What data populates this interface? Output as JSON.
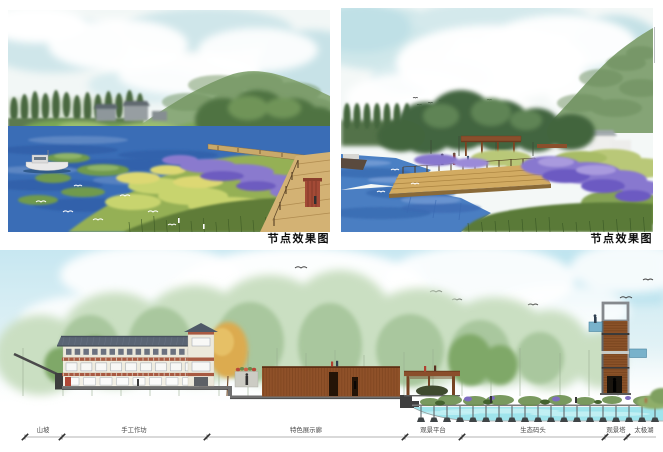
{
  "renderings": [
    {
      "caption": "节点效果图"
    },
    {
      "caption": "节点效果图"
    }
  ],
  "section": {
    "labels": [
      {
        "text": "山坡"
      },
      {
        "text": "手工作坊"
      },
      {
        "text": "特色展示廊"
      },
      {
        "text": "观景平台"
      },
      {
        "text": "生态码头"
      },
      {
        "text": "观景塔"
      },
      {
        "text": "太极湖"
      }
    ]
  },
  "colors": {
    "lake_blue": "#3a6db6",
    "shallow_water_cyan": "#9fe4ec",
    "wetland_purple": "#8878cf",
    "wetland_green": "#95b055",
    "corten_brown": "#8f5129",
    "roof_slate": "#5a6574",
    "band_red": "#a85a42",
    "mountain_green": "#85a476"
  }
}
